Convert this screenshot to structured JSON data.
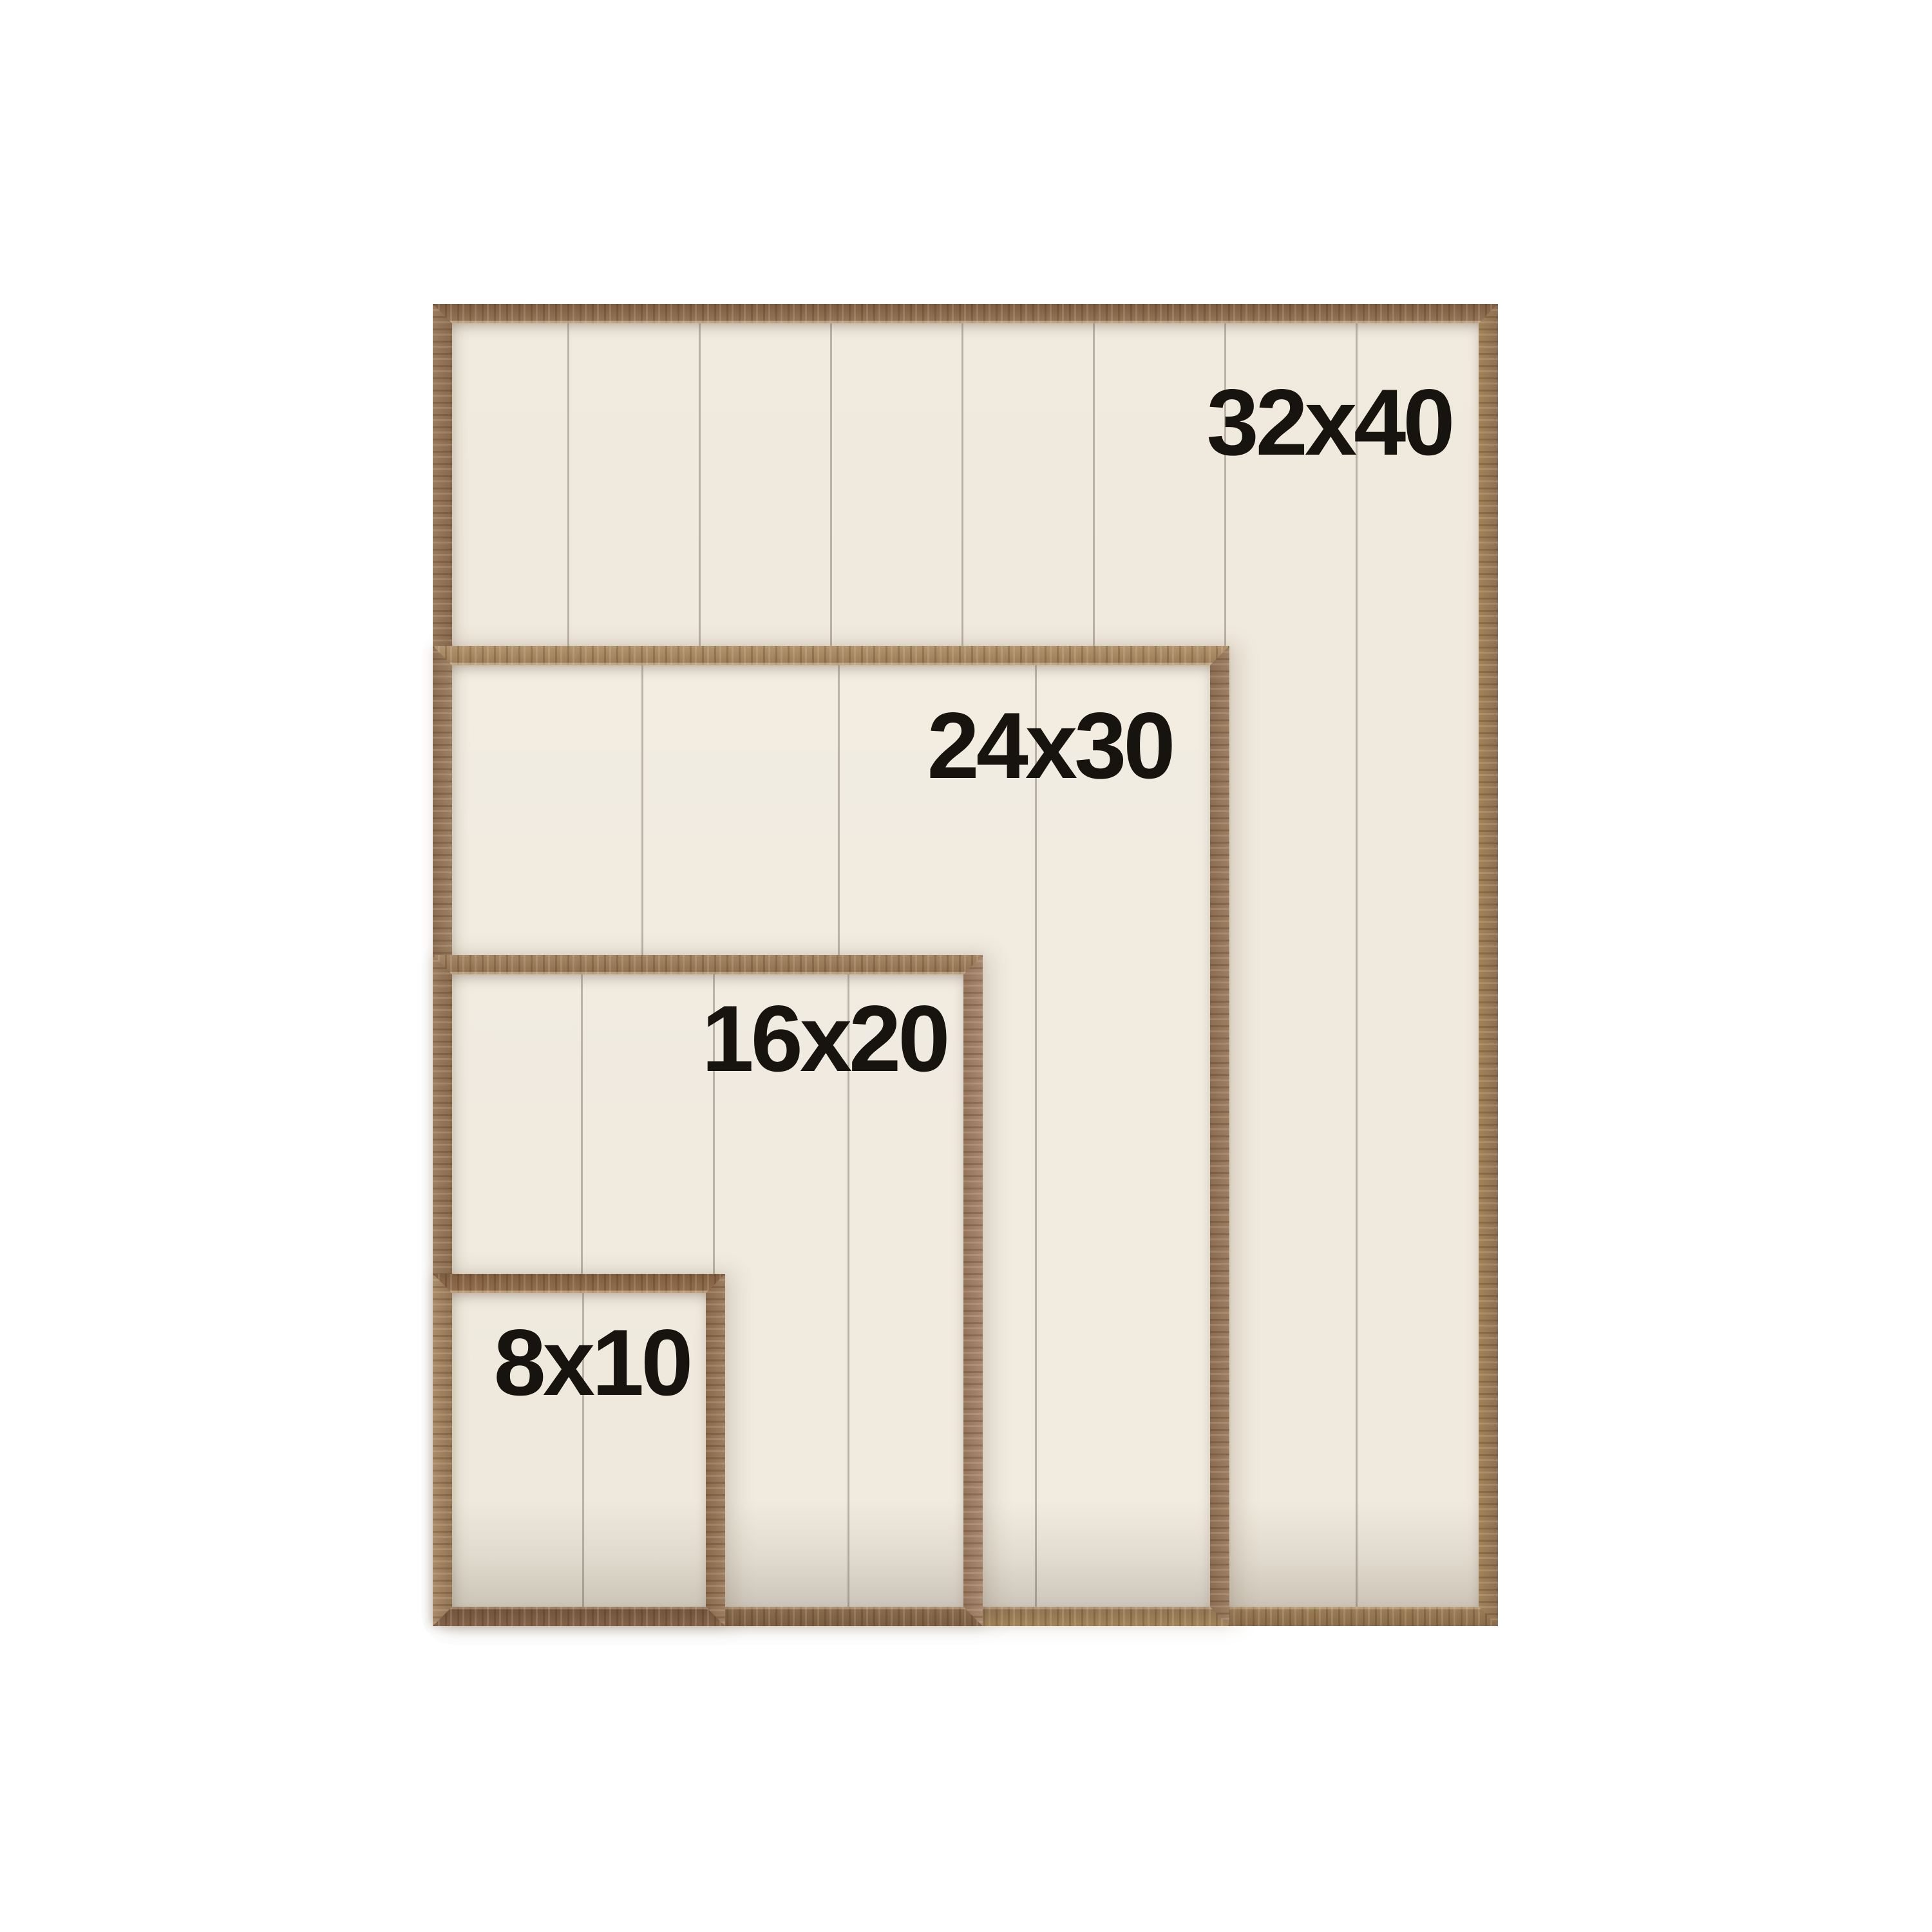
{
  "page": {
    "background": "#ffffff"
  },
  "figure": {
    "type": "size-comparison",
    "label_color": "#17130e",
    "frames": [
      {
        "label": "32x40",
        "size": {
          "width_in": 32,
          "height_in": 40
        },
        "panel": "#f0e9dd",
        "seam": "#7d766a",
        "wood": {
          "top": [
            "#7d5c3f",
            "#97775a"
          ],
          "left": [
            "#9a7c5e",
            "#87684c"
          ],
          "right": [
            "#8d6f52",
            "#a18459"
          ],
          "bottom": [
            "#9c7f57",
            "#8a6c4a"
          ]
        }
      },
      {
        "label": "24x30",
        "size": {
          "width_in": 24,
          "height_in": 30
        },
        "panel": "#f1ebe0",
        "seam": "#7d766a",
        "wood": {
          "top": [
            "#b2946e",
            "#9a7b57"
          ],
          "left": [
            "#8b6e52",
            "#9c8062"
          ],
          "right": [
            "#9d7f63",
            "#8b6d51"
          ],
          "bottom": [
            "#8f7252",
            "#a08459"
          ]
        }
      },
      {
        "label": "16x20",
        "size": {
          "width_in": 16,
          "height_in": 20
        },
        "panel": "#f0eadf",
        "seam": "#7d766a",
        "wood": {
          "top": [
            "#a58765",
            "#8d6e4e"
          ],
          "left": [
            "#9c7f60",
            "#8a6b4d"
          ],
          "right": [
            "#a8886f",
            "#93745a"
          ],
          "bottom": [
            "#8a6c4e",
            "#7b5d41"
          ]
        }
      },
      {
        "label": "8x10",
        "size": {
          "width_in": 8,
          "height_in": 10
        },
        "panel": "#efe9dd",
        "seam": "#7d766a",
        "wood": {
          "top": [
            "#7e5d40",
            "#936f4e"
          ],
          "left": [
            "#a98c69",
            "#937455"
          ],
          "right": [
            "#9d7e60",
            "#8a6a4c"
          ],
          "bottom": [
            "#6f5238",
            "#82634a"
          ]
        }
      }
    ]
  }
}
